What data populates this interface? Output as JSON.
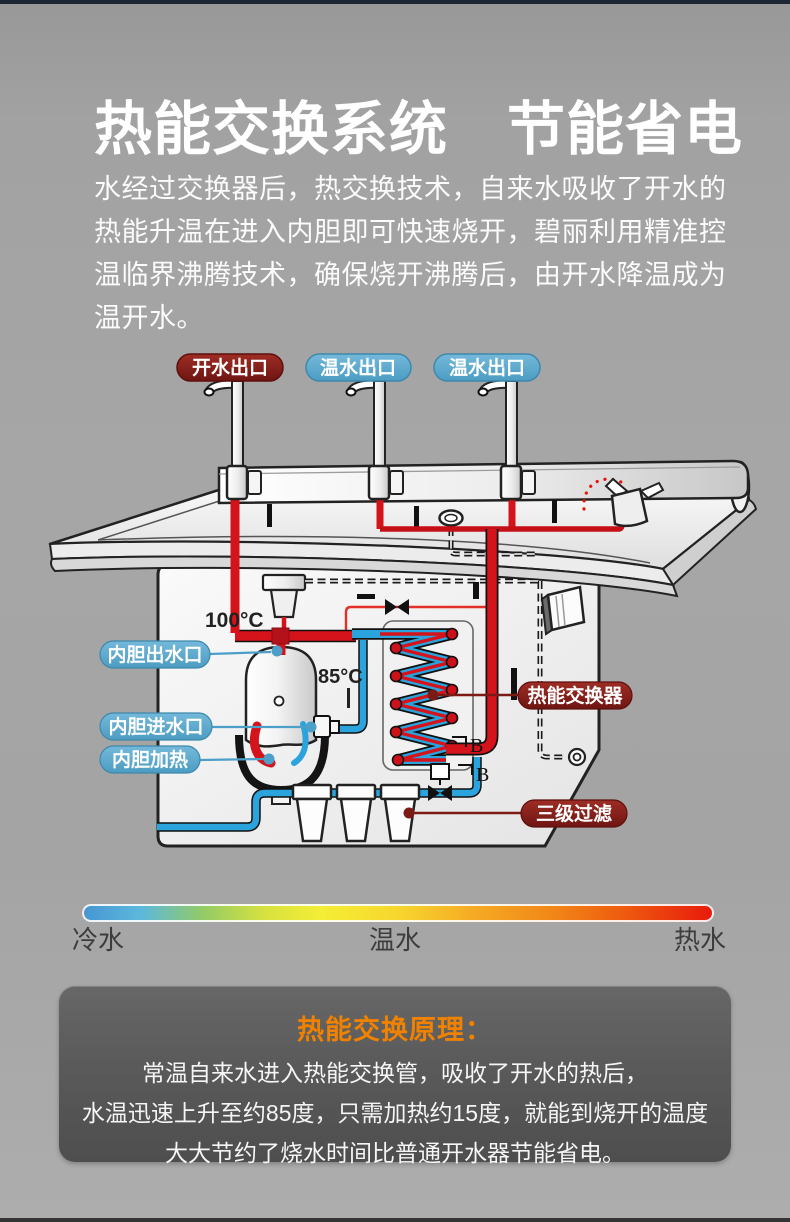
{
  "page": {
    "title": "热能交换系统　节能省电",
    "intro_lines": [
      "水经过交换器后，热交换技术，自来水吸收了开水的",
      "热能升温在进入内胆即可快速烧开，碧丽利用精准控",
      "温临界沸腾技术，确保烧开沸腾后，由开水降温成为",
      "温开水。"
    ]
  },
  "diagram": {
    "outlets": [
      {
        "label": "开水出口",
        "type": "boiling"
      },
      {
        "label": "温水出口",
        "type": "warm"
      },
      {
        "label": "温水出口",
        "type": "warm"
      }
    ],
    "labels": {
      "tank_outlet": "内胆出水口",
      "tank_inlet": "内胆进水口",
      "tank_heater": "内胆加热",
      "heat_exchanger": "热能交换器",
      "triple_filter": "三级过滤"
    },
    "temperatures": {
      "boiling": "100°C",
      "preheated": "85°C"
    },
    "markers": {
      "b_upper": "B",
      "b_lower": "B"
    }
  },
  "legend": {
    "cold": "冷水",
    "warm": "温水",
    "hot": "热水"
  },
  "principle": {
    "title": "热能交换原理：",
    "lines": [
      "常温自来水进入热能交换管，吸收了开水的热后，",
      "水温迅速上升至约85度，只需加热约15度，就能到烧开的温度",
      "大大节约了烧水时间比普通开水器节能省电。"
    ]
  },
  "colors": {
    "hot_label": "#7e201c",
    "warm_label": "#57a6c8",
    "pipe_hot": "#d5131b",
    "pipe_cold": "#2ba3dd",
    "accent_orange": "#f08200",
    "panel_bg": "#5a5a5a"
  }
}
